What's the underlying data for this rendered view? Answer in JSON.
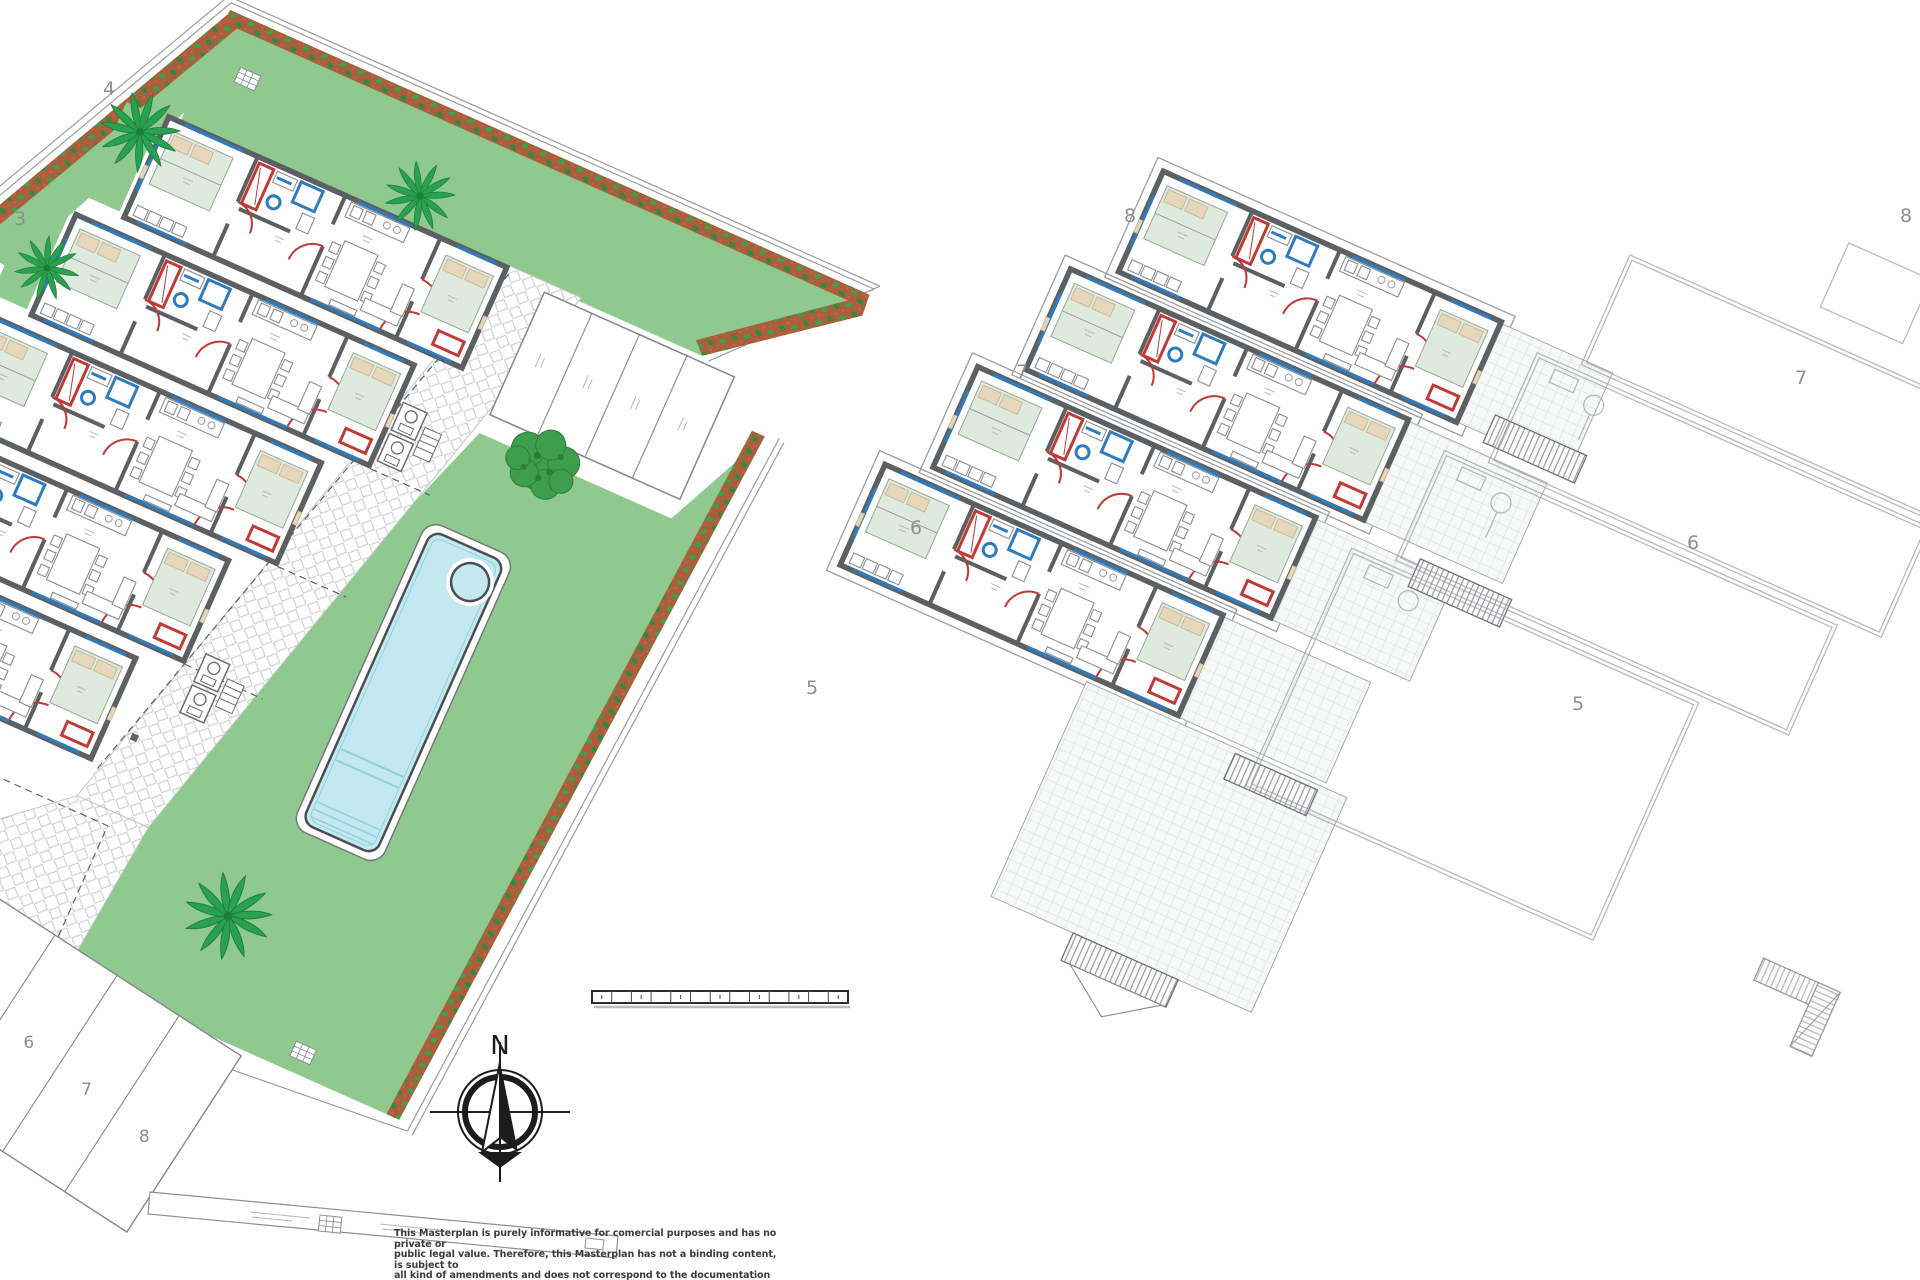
{
  "colors": {
    "wall": "#5d6063",
    "red": "#c03a36",
    "window": "#2e7cc0",
    "garden": "#8fc98f",
    "bed": "#dfeade",
    "pillow": "#e6d6ba",
    "pool": "#c3e8f0",
    "pool_line": "#8fd0de",
    "flowerbed": "#a8603a",
    "leaf": "#3da04c",
    "palm": "#2aa14e",
    "palm_dark": "#1c7e3b",
    "tree": "#3f9e4d",
    "tree_dark": "#2d7c3c",
    "pave_line": "#cbced0",
    "tile_line": "#d8dadb",
    "brick_bg": "#f1f2f3",
    "brick_line": "#c9cccd",
    "outline": "#9a9da0",
    "stair": "#6f7275",
    "rung": "#85888b",
    "label": "#8c8f92",
    "text": "#3b3b3b"
  },
  "site": {
    "left_complex": {
      "plot_labels": [
        "4",
        "3"
      ],
      "parking_labels": [
        "6",
        "7",
        "8"
      ]
    },
    "middle_complex": {
      "unit_labels": [
        "8",
        "7",
        "6",
        "5"
      ]
    },
    "right_complex": {
      "unit_labels": [
        "8",
        "7",
        "6",
        "5"
      ]
    }
  },
  "compass": {
    "north_label": "N"
  },
  "scale_bar": {
    "segments": 13
  },
  "disclaimer": {
    "lines": [
      "This Masterplan is purely informative for comercial purposes and has no private or",
      "public legal value. Therefore, this Masterplan has not a binding content, is subject to",
      "all kind of amendments and does not correspond to the documentation that must be",
      "submitted for the municipal licences."
    ]
  }
}
